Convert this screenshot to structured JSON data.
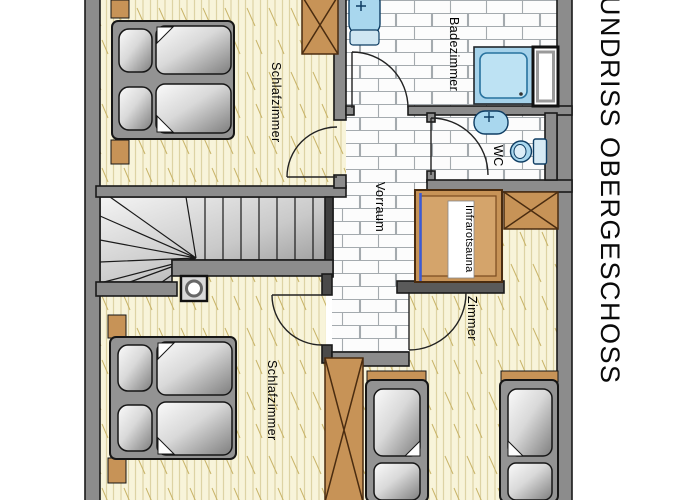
{
  "title": "UNDRISS OBERGESCHOSS",
  "labels": {
    "bedroom_top": "Schlafzimmer",
    "bedroom_bottom": "Schlafzimmer",
    "bathroom": "Badezimmer",
    "wc": "WC",
    "hallway": "Vorraum",
    "sauna": "Infrarotsauna",
    "room": "Zimmer"
  },
  "colors": {
    "wall_gray": "#8c8c8c",
    "wood_floor": "#f8f4da",
    "wood_stripe": "#ddd3a4",
    "tile_line": "#a4aaae",
    "furniture_tan": "#c79357",
    "fixture_blue": "#a9d7ee",
    "sauna_glass_blue": "#3b5bd6",
    "stair_light": "#f2f2f2",
    "stair_dark": "#8e8e8e"
  }
}
